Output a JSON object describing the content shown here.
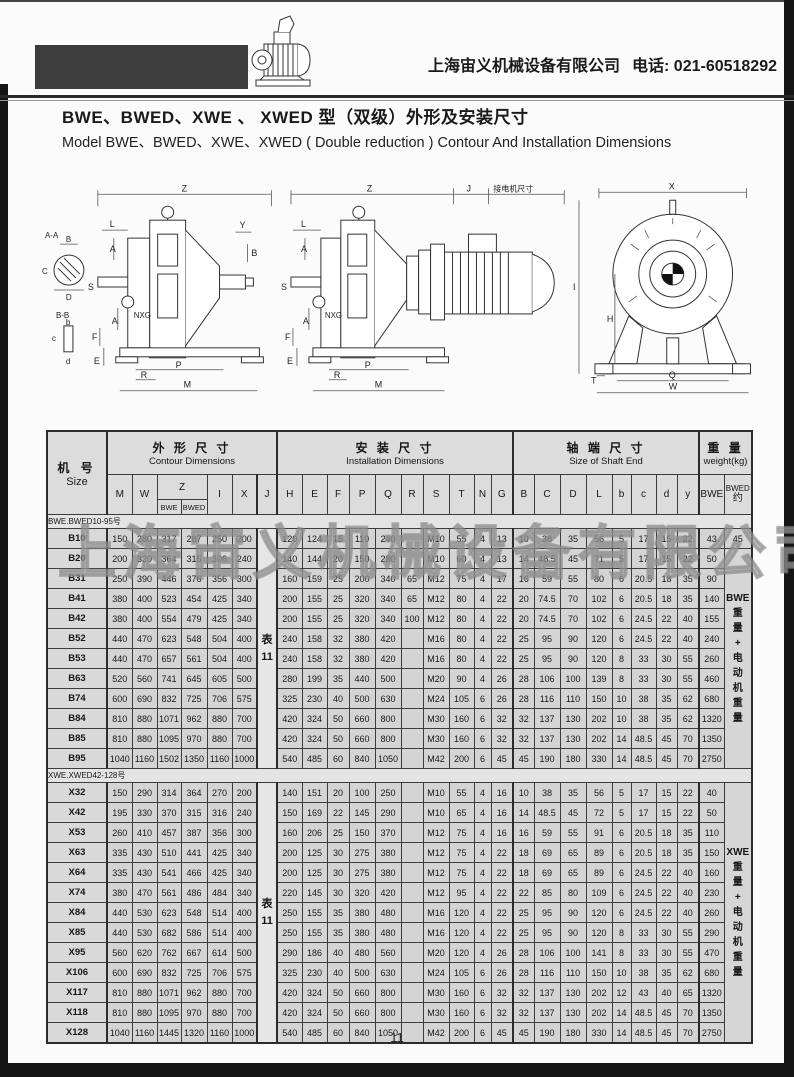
{
  "header": {
    "company": "上海宙义机械设备有限公司",
    "phone": "电话: 021-60518292"
  },
  "title": {
    "zh": "BWE、BWED、XWE 、 XWED 型（双级）外形及安装尺寸",
    "en": "Model BWE、BWED、XWE、XWED ( Double reduction ) Contour And Installation Dimensions"
  },
  "diagrams": {
    "motor_note": "接电机尺寸",
    "labels": {
      "z": "Z",
      "j": "J",
      "x": "X",
      "i": "I",
      "h": "H",
      "q": "Q",
      "w": "W",
      "t": "T",
      "m": "M",
      "p": "P",
      "r": "R",
      "e": "E",
      "f": "F",
      "l": "L",
      "a": "A",
      "y": "Y",
      "b": "B",
      "s": "S",
      "nxg": "NXG",
      "sec_aa": "A-A",
      "sec_bb": "B-B",
      "c": "C",
      "d": "D",
      "b_lc": "b",
      "c_lc": "c",
      "d_lc": "d"
    }
  },
  "watermark": "上海宙义机械设备有限公司",
  "page_number": "11",
  "table": {
    "headers": {
      "size_zh": "机 号",
      "size_en": "Size",
      "contour_zh": "外 形 尺 寸",
      "contour_en": "Contour Dimensions",
      "install_zh": "安 装 尺 寸",
      "install_en": "Installation Dimensions",
      "shaft_zh": "轴 端 尺 寸",
      "shaft_en": "Size of Shaft End",
      "weight_zh": "重 量",
      "weight_en": "weight(kg)",
      "cols": {
        "m": "M",
        "w": "W",
        "z": "Z",
        "z_bwe": "BWE",
        "z_bwed": "BWED",
        "i": "I",
        "x": "X",
        "j": "J",
        "h": "H",
        "e": "E",
        "f": "F",
        "p": "P",
        "q": "Q",
        "r": "R",
        "s": "S",
        "t": "T",
        "n": "N",
        "g": "G",
        "b": "B",
        "c": "C",
        "d": "D",
        "l": "L",
        "b_lc": "b",
        "c_lc": "c",
        "d_lc": "d",
        "y_lc": "y",
        "w_bwe": "BWE",
        "w_bwed": "BWED",
        "w_approx": "约"
      }
    },
    "sections": [
      {
        "label": "BWE.BWED10-95号",
        "j_note": "表\n11",
        "rows": [
          {
            "size": "B10",
            "contour": [
              "150",
              "280",
              "317",
              "287",
              "250",
              "200"
            ],
            "install": [
              "120",
              "124",
              "15",
              "110",
              "240",
              "",
              "M10",
              "55",
              "4",
              "13"
            ],
            "shaft": [
              "10",
              "38",
              "35",
              "56",
              "5",
              "17",
              "15",
              "22"
            ],
            "weight_bwe": "43",
            "weight_bwed": "45"
          },
          {
            "size": "B20",
            "contour": [
              "200",
              "320",
              "364",
              "315",
              "306",
              "240"
            ],
            "install": [
              "140",
              "144",
              "20",
              "150",
              "280",
              "",
              "M10",
              "60",
              "4",
              "13"
            ],
            "shaft": [
              "14",
              "48.5",
              "45",
              "71",
              "5",
              "17",
              "15",
              "22"
            ],
            "weight_bwe": "50",
            "weight_note": "BWE\n重\n量\n+\n电\n动\n机\n重\n量",
            "note_span": 11
          },
          {
            "size": "B31",
            "contour": [
              "250",
              "390",
              "446",
              "376",
              "356",
              "300"
            ],
            "install": [
              "160",
              "159",
              "25",
              "200",
              "340",
              "65",
              "M12",
              "75",
              "4",
              "17"
            ],
            "shaft": [
              "16",
              "59",
              "55",
              "80",
              "6",
              "20.5",
              "18",
              "35"
            ],
            "weight_bwe": "90"
          },
          {
            "size": "B41",
            "contour": [
              "380",
              "400",
              "523",
              "454",
              "425",
              "340"
            ],
            "install": [
              "200",
              "155",
              "25",
              "320",
              "340",
              "65",
              "M12",
              "80",
              "4",
              "22"
            ],
            "shaft": [
              "20",
              "74.5",
              "70",
              "102",
              "6",
              "20.5",
              "18",
              "35"
            ],
            "weight_bwe": "140"
          },
          {
            "size": "B42",
            "contour": [
              "380",
              "400",
              "554",
              "479",
              "425",
              "340"
            ],
            "install": [
              "200",
              "155",
              "25",
              "320",
              "340",
              "100",
              "M12",
              "80",
              "4",
              "22"
            ],
            "shaft": [
              "20",
              "74.5",
              "70",
              "102",
              "6",
              "24.5",
              "22",
              "40"
            ],
            "weight_bwe": "155"
          },
          {
            "size": "B52",
            "contour": [
              "440",
              "470",
              "623",
              "548",
              "504",
              "400"
            ],
            "install": [
              "240",
              "158",
              "32",
              "380",
              "420",
              "",
              "M16",
              "80",
              "4",
              "22"
            ],
            "shaft": [
              "25",
              "95",
              "90",
              "120",
              "6",
              "24.5",
              "22",
              "40"
            ],
            "weight_bwe": "240"
          },
          {
            "size": "B53",
            "contour": [
              "440",
              "470",
              "657",
              "561",
              "504",
              "400"
            ],
            "install": [
              "240",
              "158",
              "32",
              "380",
              "420",
              "",
              "M16",
              "80",
              "4",
              "22"
            ],
            "shaft": [
              "25",
              "95",
              "90",
              "120",
              "8",
              "33",
              "30",
              "55"
            ],
            "weight_bwe": "260"
          },
          {
            "size": "B63",
            "contour": [
              "520",
              "560",
              "741",
              "645",
              "605",
              "500"
            ],
            "install": [
              "280",
              "199",
              "35",
              "440",
              "500",
              "",
              "M20",
              "90",
              "4",
              "26"
            ],
            "shaft": [
              "28",
              "106",
              "100",
              "139",
              "8",
              "33",
              "30",
              "55"
            ],
            "weight_bwe": "460"
          },
          {
            "size": "B74",
            "contour": [
              "600",
              "690",
              "832",
              "725",
              "706",
              "575"
            ],
            "install": [
              "325",
              "230",
              "40",
              "500",
              "630",
              "",
              "M24",
              "105",
              "6",
              "26"
            ],
            "shaft": [
              "28",
              "116",
              "110",
              "150",
              "10",
              "38",
              "35",
              "62"
            ],
            "weight_bwe": "680"
          },
          {
            "size": "B84",
            "contour": [
              "810",
              "880",
              "1071",
              "962",
              "880",
              "700"
            ],
            "install": [
              "420",
              "324",
              "50",
              "660",
              "800",
              "",
              "M30",
              "160",
              "6",
              "32"
            ],
            "shaft": [
              "32",
              "137",
              "130",
              "202",
              "10",
              "38",
              "35",
              "62"
            ],
            "weight_bwe": "1320"
          },
          {
            "size": "B85",
            "contour": [
              "810",
              "880",
              "1095",
              "970",
              "880",
              "700"
            ],
            "install": [
              "420",
              "324",
              "50",
              "660",
              "800",
              "",
              "M30",
              "160",
              "6",
              "32"
            ],
            "shaft": [
              "32",
              "137",
              "130",
              "202",
              "14",
              "48.5",
              "45",
              "70"
            ],
            "weight_bwe": "1350"
          },
          {
            "size": "B95",
            "contour": [
              "1040",
              "1160",
              "1502",
              "1350",
              "1160",
              "1000"
            ],
            "install": [
              "540",
              "485",
              "60",
              "840",
              "1050",
              "",
              "M42",
              "200",
              "6",
              "45"
            ],
            "shaft": [
              "45",
              "190",
              "180",
              "330",
              "14",
              "48.5",
              "45",
              "70"
            ],
            "weight_bwe": "2750"
          }
        ]
      },
      {
        "label": "XWE.XWED42-128号",
        "j_note": "表\n11",
        "rows": [
          {
            "size": "X32",
            "contour": [
              "150",
              "290",
              "314",
              "364",
              "270",
              "200"
            ],
            "install": [
              "140",
              "151",
              "20",
              "100",
              "250",
              "",
              "M10",
              "55",
              "4",
              "16"
            ],
            "shaft": [
              "10",
              "38",
              "35",
              "56",
              "5",
              "17",
              "15",
              "22"
            ],
            "weight_bwe": "40",
            "weight_note": "XWE\n重\n量\n+\n电\n动\n机\n重\n量",
            "note_span": 13
          },
          {
            "size": "X42",
            "contour": [
              "195",
              "330",
              "370",
              "315",
              "316",
              "240"
            ],
            "install": [
              "150",
              "169",
              "22",
              "145",
              "290",
              "",
              "M10",
              "65",
              "4",
              "16"
            ],
            "shaft": [
              "14",
              "48.5",
              "45",
              "72",
              "5",
              "17",
              "15",
              "22"
            ],
            "weight_bwe": "50"
          },
          {
            "size": "X53",
            "contour": [
              "260",
              "410",
              "457",
              "387",
              "356",
              "300"
            ],
            "install": [
              "160",
              "206",
              "25",
              "150",
              "370",
              "",
              "M12",
              "75",
              "4",
              "16"
            ],
            "shaft": [
              "16",
              "59",
              "55",
              "91",
              "6",
              "20.5",
              "18",
              "35"
            ],
            "weight_bwe": "110"
          },
          {
            "size": "X63",
            "contour": [
              "335",
              "430",
              "510",
              "441",
              "425",
              "340"
            ],
            "install": [
              "200",
              "125",
              "30",
              "275",
              "380",
              "",
              "M12",
              "75",
              "4",
              "22"
            ],
            "shaft": [
              "18",
              "69",
              "65",
              "89",
              "6",
              "20.5",
              "18",
              "35"
            ],
            "weight_bwe": "150"
          },
          {
            "size": "X64",
            "contour": [
              "335",
              "430",
              "541",
              "466",
              "425",
              "340"
            ],
            "install": [
              "200",
              "125",
              "30",
              "275",
              "380",
              "",
              "M12",
              "75",
              "4",
              "22"
            ],
            "shaft": [
              "18",
              "69",
              "65",
              "89",
              "6",
              "24.5",
              "22",
              "40"
            ],
            "weight_bwe": "160"
          },
          {
            "size": "X74",
            "contour": [
              "380",
              "470",
              "561",
              "486",
              "484",
              "340"
            ],
            "install": [
              "220",
              "145",
              "30",
              "320",
              "420",
              "",
              "M12",
              "95",
              "4",
              "22"
            ],
            "shaft": [
              "22",
              "85",
              "80",
              "109",
              "6",
              "24.5",
              "22",
              "40"
            ],
            "weight_bwe": "230"
          },
          {
            "size": "X84",
            "contour": [
              "440",
              "530",
              "623",
              "548",
              "514",
              "400"
            ],
            "install": [
              "250",
              "155",
              "35",
              "380",
              "480",
              "",
              "M16",
              "120",
              "4",
              "22"
            ],
            "shaft": [
              "25",
              "95",
              "90",
              "120",
              "6",
              "24.5",
              "22",
              "40"
            ],
            "weight_bwe": "260"
          },
          {
            "size": "X85",
            "contour": [
              "440",
              "530",
              "682",
              "586",
              "514",
              "400"
            ],
            "install": [
              "250",
              "155",
              "35",
              "380",
              "480",
              "",
              "M16",
              "120",
              "4",
              "22"
            ],
            "shaft": [
              "25",
              "95",
              "90",
              "120",
              "8",
              "33",
              "30",
              "55"
            ],
            "weight_bwe": "290"
          },
          {
            "size": "X95",
            "contour": [
              "560",
              "620",
              "762",
              "667",
              "614",
              "500"
            ],
            "install": [
              "290",
              "186",
              "40",
              "480",
              "560",
              "",
              "M20",
              "120",
              "4",
              "26"
            ],
            "shaft": [
              "28",
              "106",
              "100",
              "141",
              "8",
              "33",
              "30",
              "55"
            ],
            "weight_bwe": "470"
          },
          {
            "size": "X106",
            "contour": [
              "600",
              "690",
              "832",
              "725",
              "706",
              "575"
            ],
            "install": [
              "325",
              "230",
              "40",
              "500",
              "630",
              "",
              "M24",
              "105",
              "6",
              "26"
            ],
            "shaft": [
              "28",
              "116",
              "110",
              "150",
              "10",
              "38",
              "35",
              "62"
            ],
            "weight_bwe": "680"
          },
          {
            "size": "X117",
            "contour": [
              "810",
              "880",
              "1071",
              "962",
              "880",
              "700"
            ],
            "install": [
              "420",
              "324",
              "50",
              "660",
              "800",
              "",
              "M30",
              "160",
              "6",
              "32"
            ],
            "shaft": [
              "32",
              "137",
              "130",
              "202",
              "12",
              "43",
              "40",
              "65"
            ],
            "weight_bwe": "1320"
          },
          {
            "size": "X118",
            "contour": [
              "810",
              "880",
              "1095",
              "970",
              "880",
              "700"
            ],
            "install": [
              "420",
              "324",
              "50",
              "660",
              "800",
              "",
              "M30",
              "160",
              "6",
              "32"
            ],
            "shaft": [
              "32",
              "137",
              "130",
              "202",
              "14",
              "48.5",
              "45",
              "70"
            ],
            "weight_bwe": "1350"
          },
          {
            "size": "X128",
            "contour": [
              "1040",
              "1160",
              "1445",
              "1320",
              "1160",
              "1000"
            ],
            "install": [
              "540",
              "485",
              "60",
              "840",
              "1050",
              "",
              "M42",
              "200",
              "6",
              "45"
            ],
            "shaft": [
              "45",
              "190",
              "180",
              "330",
              "14",
              "48.5",
              "45",
              "70"
            ],
            "weight_bwe": "2750"
          }
        ]
      }
    ]
  }
}
